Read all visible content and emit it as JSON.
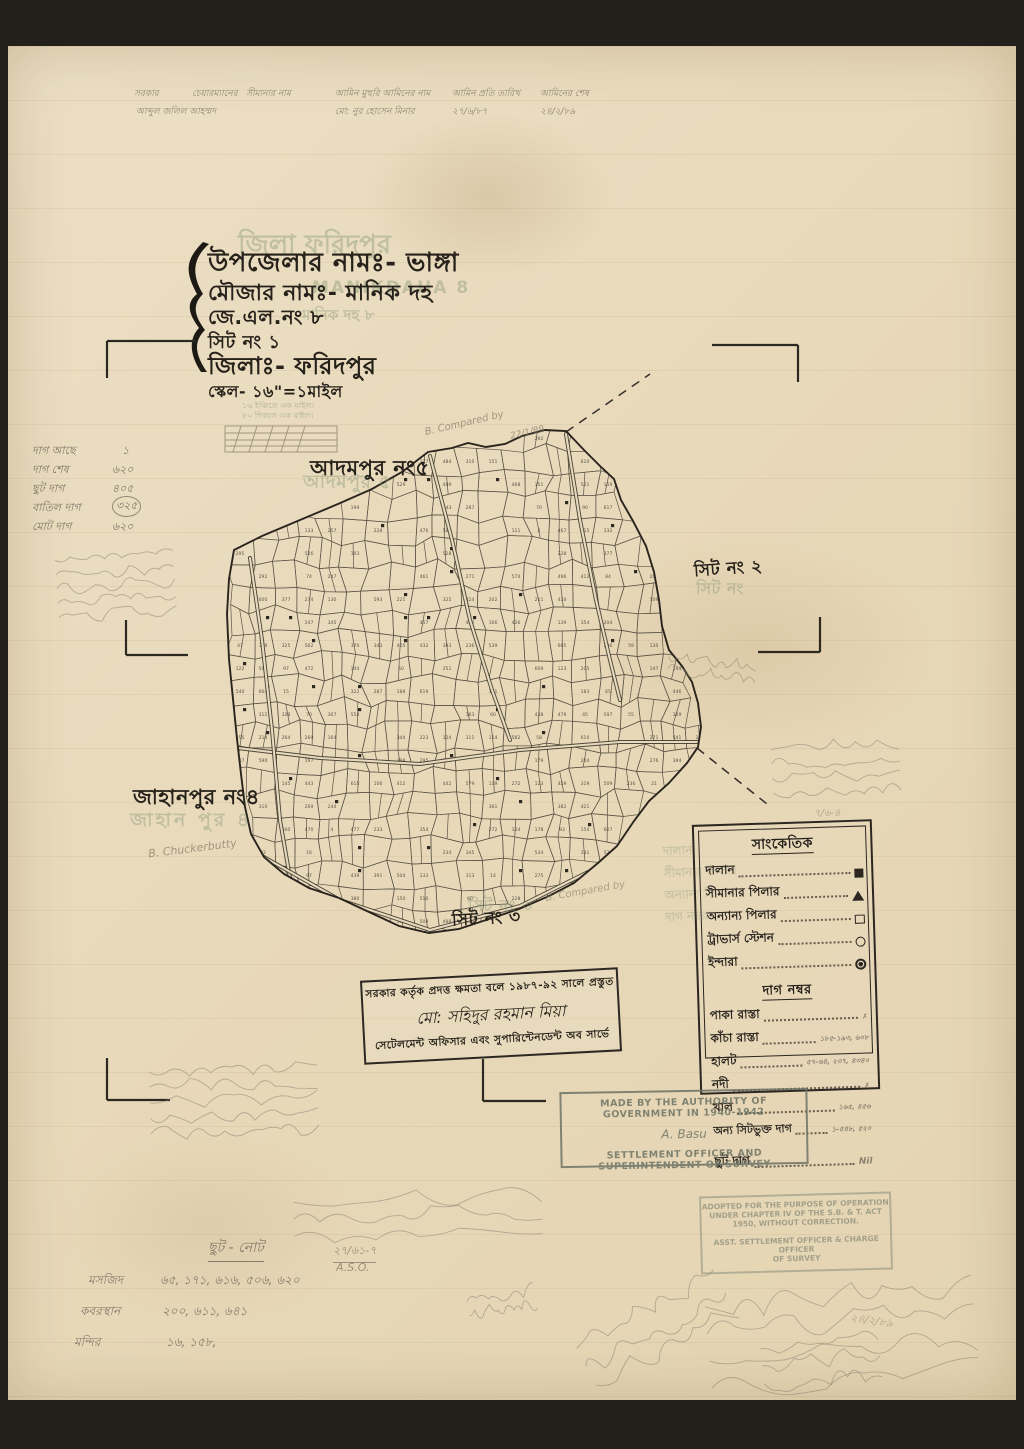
{
  "page": {
    "description": "Scanned cadastral mouza survey sheet, Bangladesh"
  },
  "header_row": {
    "line1": [
      "সরকার",
      "চেয়ারম্যানের",
      "সীমানার নাম",
      "আমিন মুহুরি আমিনের নাম",
      "আমিন প্রতি তারিখ",
      "আমিনের শেষ"
    ],
    "line2": [
      "আব্দুল জলিল আহম্মদ",
      "মো: নুর হোসেন মিনার",
      "২৭/৬/৮৭",
      "২৪/২/৮৯"
    ]
  },
  "title_block": {
    "line1": "উপজেলার নামঃ- ভাঙ্গা",
    "line2": "মৌজার নামঃ- মানিক দহ",
    "line3": "জে.এল.নং ৮",
    "line4": "সিট নং ১",
    "line5": "জিলাঃ- ফরিদপুর",
    "line6": "স্কেল- ১৬\"=১মাইল",
    "faded1": "জিলা ফরিদপুর",
    "faded2": "MANIKDAHA 8",
    "faded3": "মানিক দহ ৮",
    "scale_note1": "১৬ ইঞ্চিতে এক মাইল।",
    "scale_note2": "৮০ শিকলে এক মাইল।"
  },
  "margin_list": {
    "rows": [
      {
        "label": "দাগ আছে",
        "value": "১"
      },
      {
        "label": "দাগ শেষ",
        "value": "৬২০"
      },
      {
        "label": "ছুট দাগ",
        "value": "৪০৫"
      },
      {
        "label": "বাতিল দাগ",
        "value": "৩২৫"
      },
      {
        "label": "মোট দাগ",
        "value": "৬২০"
      }
    ]
  },
  "map_labels": {
    "adampur": "আদমপুর নং৫",
    "adampur_faded": "আদমপুর ৫",
    "sheet2": "সিট নং ২",
    "sheet2_faded": "সিট নং",
    "jahanpur": "জাহানপুর নং৪",
    "jahanpur_faded": "জাহান পুর ৪",
    "sheet3": "সিট নং ৩",
    "sheet3_faded": "সিট নং ৩"
  },
  "legend": {
    "title": "সাংকেতিক",
    "symbol_items": [
      {
        "label": "দালান",
        "symbol": "filled-square"
      },
      {
        "label": "সীমানার পিলার",
        "symbol": "filled-triangle"
      },
      {
        "label": "অন্যান্য পিলার",
        "symbol": "open-square"
      },
      {
        "label": "ট্রাভার্স স্টেশন",
        "symbol": "open-circle"
      },
      {
        "label": "ইন্দারা",
        "symbol": "target-circle"
      }
    ],
    "dag_title": "দাগ নম্বর",
    "dag_items": [
      {
        "label": "পাকা রাস্তা",
        "value": "✗"
      },
      {
        "label": "কাঁচা রাস্তা",
        "value": "১৮৫-১৯৩, ৬০৮"
      },
      {
        "label": "হালট",
        "value": "৫৭-৬৪, ২৩৭, ৪৩৪০"
      },
      {
        "label": "নদী",
        "value": "✗"
      },
      {
        "label": "খাল",
        "value": "১৬৫, ৪৫৬"
      },
      {
        "label": "অন্য সিটভুক্ত দাগ",
        "value": "১-৫৪৮, ৫২০"
      }
    ],
    "chhut": {
      "label": "ছুট দাগ",
      "value": "Nil"
    }
  },
  "stamps": {
    "bengali": {
      "line1": "সরকার কর্তৃক প্রদত্ত ক্ষমতা বলে ১৯৮৭-৯২ সালে প্রস্তুত",
      "signature": "মো: সহিদুর রহমান মিয়া",
      "line2": "সেটেলমেন্ট অফিসার এবং সুপারিন্টেনডেন্ট অব সার্ভে"
    },
    "english": {
      "line1": "MADE BY THE AUTHORITY OF GOVERNMENT IN 1940-1942",
      "signature": "A. Basu",
      "line2": "SETTLEMENT OFFICER AND SUPERINTENDENT OF SURVEY"
    },
    "adopted": {
      "line1": "ADOPTED FOR THE PURPOSE OF OPERATION",
      "line2": "UNDER CHAPTER IV OF THE S.B. & T. ACT",
      "line3": "1950, WITHOUT CORRECTION.",
      "line4": "ASST. SETTLEMENT OFFICER & CHARGE OFFICER",
      "line5": "OF SURVEY"
    }
  },
  "notes_bottom_left": {
    "title": "ছুট - নোট",
    "rows": [
      {
        "label": "মসজিদ",
        "value": "৬৫, ১৭১, ৬১৬, ৫০৬, ৬২০"
      },
      {
        "label": "কবরস্থান",
        "value": "২০০, ৬১১, ৬৪১"
      },
      {
        "label": "মন্দির",
        "value": "১৬, ১৫৮,"
      }
    ]
  },
  "annotations": {
    "compared_top": "B. Compared by",
    "compared_top_date": "22/1/89",
    "chuckerbutty": "B. Chuckerbutty",
    "compared_sheet3": "B. Compared by",
    "aso_ref": "২৭/৬১-৭",
    "aso": "A.S.O.",
    "right_ref": "৭/৬-৪",
    "date_right": "২৪/২/৮৯"
  },
  "colors": {
    "ink": "#26221b",
    "green_faded": "#7d9371",
    "pencil": "#837a68",
    "paper": "#e8dabd",
    "stamp_grey": "#6e7466"
  }
}
